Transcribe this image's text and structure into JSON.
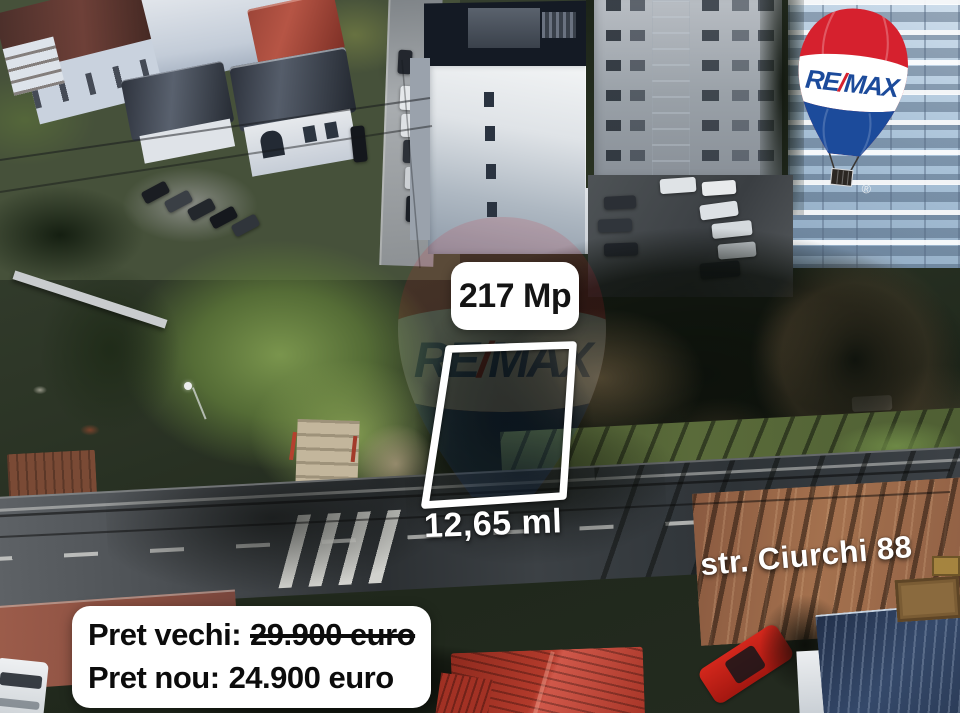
{
  "photo": {
    "description": "Aerial drone photo of a 217 sqm land plot for sale between houses and apartment blocks, street in front"
  },
  "labels": {
    "area": "217 Mp",
    "frontage": "12,65 ml",
    "street": "str. Ciurchi 88"
  },
  "pricing": {
    "old_label": "Pret vechi:",
    "old_value": "29.900 euro",
    "new_label": "Pret nou:",
    "new_value": "24.900 euro"
  },
  "brand": {
    "name": "RE/MAX",
    "re": "RE",
    "slash": "/",
    "max": "MAX",
    "registered": "®"
  },
  "colors": {
    "remax_red": "#D6212E",
    "remax_blue": "#1C4B9B",
    "label_background": "#FFFFFF",
    "label_text": "#141414",
    "plot_outline": "#FFFFFF",
    "overlay_text": "#FFFFFF"
  }
}
